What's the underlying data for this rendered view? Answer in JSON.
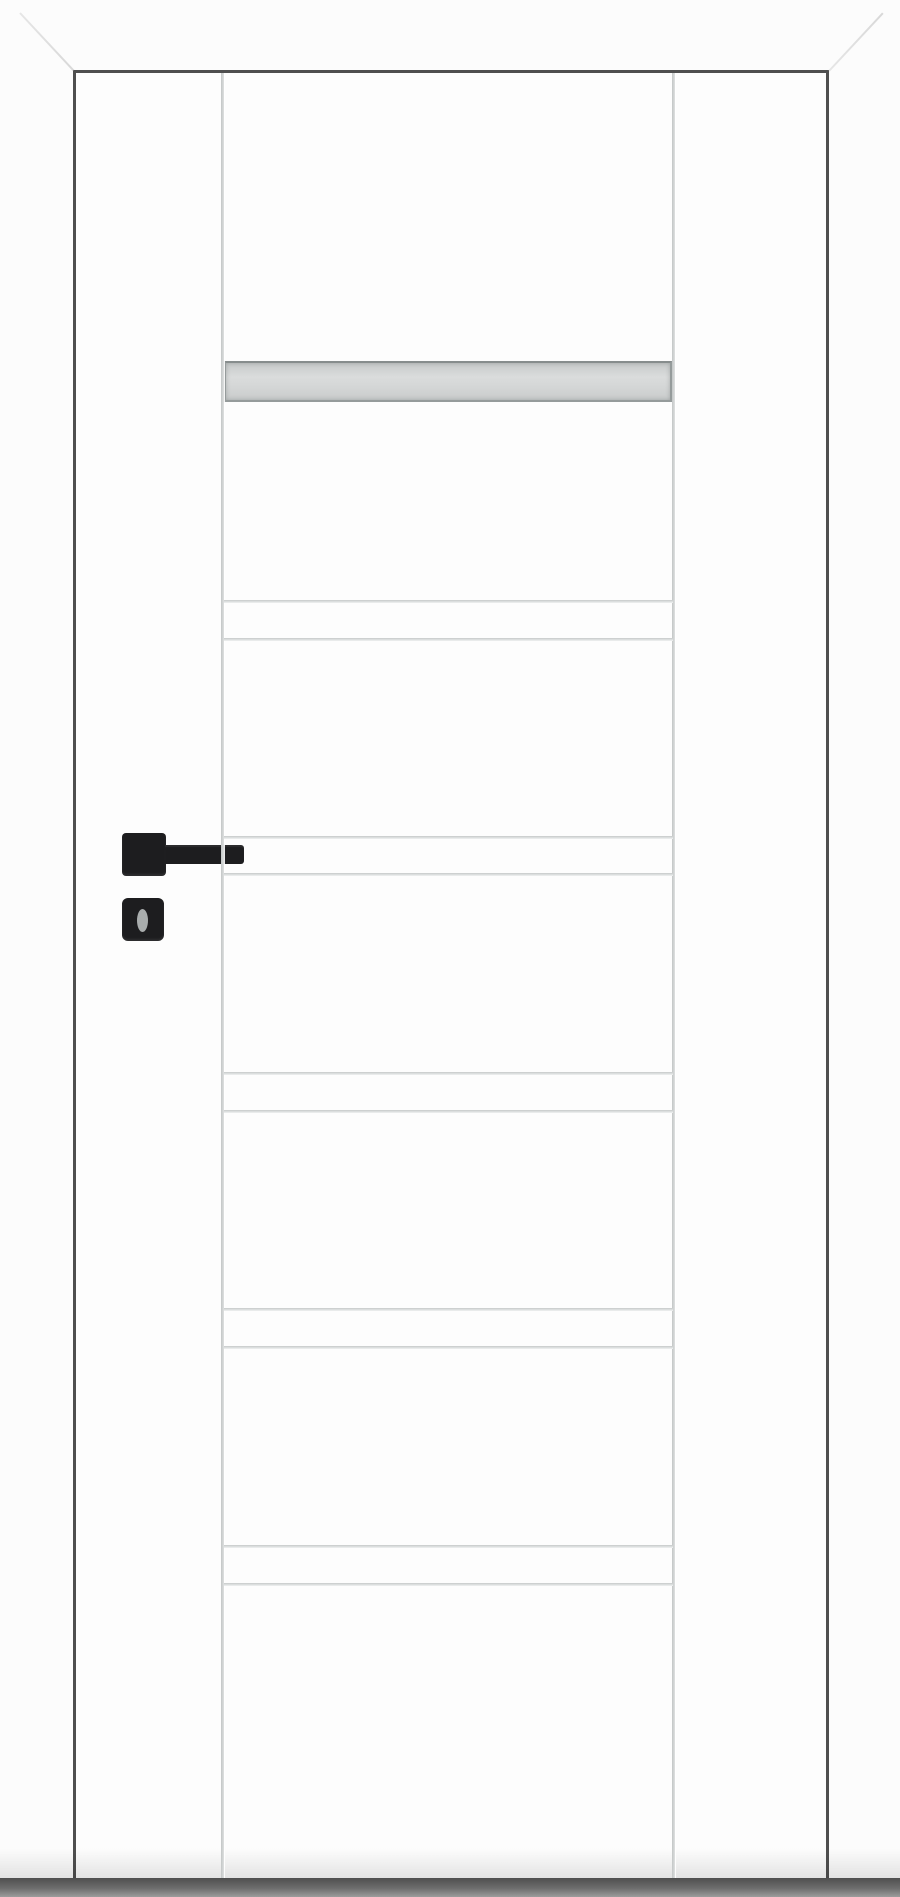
{
  "meta": {
    "subject": "White interior door, front product view",
    "details": "White door leaf in white casing with mitred top corners, frosted glass strip near top, five paired horizontal grooves on the centre panel, two full-height vertical grooves, black square-rose lever handle with separate key escutcheon, dark floor shadow under the door"
  },
  "colors": {
    "wall": "#fcfcfc",
    "leaf": "#fdfdfd",
    "frame_gap": "#4f4f4f",
    "groove": "#c6c9c9",
    "groove_highlight": "#f0f2f2",
    "glass_fill_dark": "#c7caca",
    "glass_fill_light": "#dadcdc",
    "glass_border": "#959b9b",
    "handle_black": "#1d1d1f",
    "keyhole": "#a9adad",
    "miter_line": "#e6e6e6",
    "floor_shadow_dark": "#4f4f4f",
    "floor_shadow_light": "#9c9c9c"
  },
  "geometry": {
    "canvas": {
      "x": 0,
      "y": 0,
      "w": 900,
      "h": 1897
    },
    "leaf": {
      "x": 76,
      "y": 73,
      "w": 750,
      "h": 1806
    },
    "frame": {
      "gap_top": {
        "x": 74,
        "y": 70,
        "w": 755,
        "h": 3
      },
      "gap_left": {
        "x": 73,
        "y": 70,
        "w": 3,
        "h": 1813
      },
      "gap_right": {
        "x": 826,
        "y": 70,
        "w": 3,
        "h": 1813
      },
      "miter_top_left": {
        "x1": 20,
        "y1": 12,
        "x2": 74,
        "y2": 70
      },
      "miter_top_right": {
        "x1": 829,
        "y1": 70,
        "x2": 883,
        "y2": 12
      }
    },
    "vertical_grooves": [
      {
        "x": 221
      },
      {
        "x": 672
      }
    ],
    "glass": {
      "x": 224,
      "y": 361,
      "w": 448,
      "h": 41
    },
    "groove_line_span": {
      "x": 224,
      "w": 449
    },
    "groove_lines_y": [
      600,
      638,
      836,
      873,
      1072,
      1110,
      1308,
      1346,
      1545,
      1583
    ],
    "handle": {
      "rose": {
        "x": 122,
        "y": 833,
        "w": 44,
        "h": 43
      },
      "lever": {
        "x": 165,
        "y": 845,
        "w": 79,
        "h": 19
      },
      "escutcheon": {
        "x": 122,
        "y": 898,
        "w": 42,
        "h": 43
      },
      "keyhole": {
        "x": 137,
        "y": 909,
        "w": 11,
        "h": 23
      }
    },
    "pre_shadow": {
      "x": 0,
      "y": 1848,
      "w": 900,
      "h": 30
    },
    "floor_shadow": {
      "x": 0,
      "y": 1878,
      "w": 900,
      "h": 19
    }
  }
}
